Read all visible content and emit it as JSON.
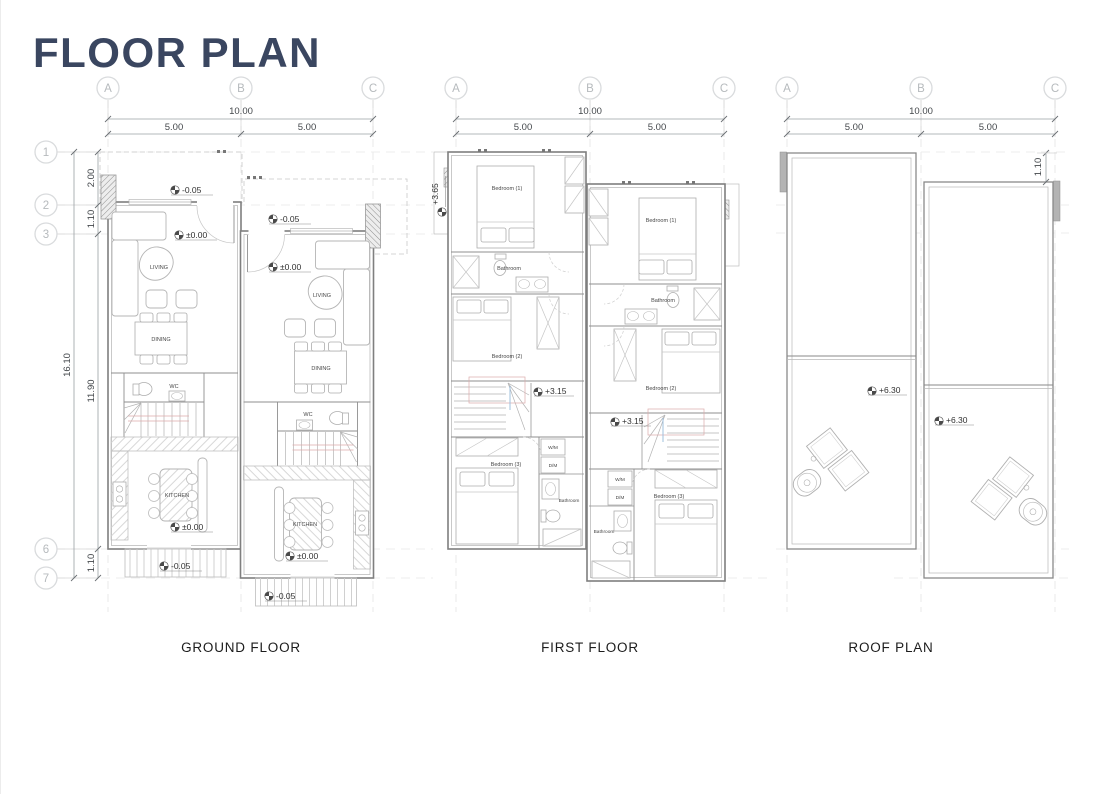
{
  "title": "FLOOR PLAN",
  "grid": {
    "cols": [
      "A",
      "B",
      "C"
    ],
    "rows": [
      "1",
      "2",
      "3",
      "6",
      "7"
    ]
  },
  "dims": {
    "total": "10.00",
    "half": "5.00",
    "d200": "2.00",
    "d110": "1.10",
    "d1610": "16.10",
    "d1190": "11.90"
  },
  "ground": {
    "caption": "GROUND FLOOR",
    "rooms": {
      "living": "LIVING",
      "dining": "DINING",
      "wc": "WC",
      "kitchen": "KITCHEN"
    },
    "levels": {
      "minus005": "-0.05",
      "zero": "±0.00"
    }
  },
  "first": {
    "caption": "FIRST FLOOR",
    "rooms": {
      "bed1": "Bedroom (1)",
      "bed2": "Bedroom (2)",
      "bed3": "Bedroom (3)",
      "bath": "Bathroom",
      "wm": "W/M",
      "dm": "D/M"
    },
    "levels": {
      "p365": "+3.65",
      "p315": "+3.15"
    }
  },
  "roof": {
    "caption": "ROOF PLAN",
    "levels": {
      "p630": "+6.30"
    },
    "dims": {
      "offset": "1.10"
    }
  },
  "colors": {
    "title": "#3a4660",
    "wall": "#7f7f7f",
    "dim_text": "#43474b",
    "bubble": "#b6babd",
    "stair_guide": "#dcaaaa"
  }
}
